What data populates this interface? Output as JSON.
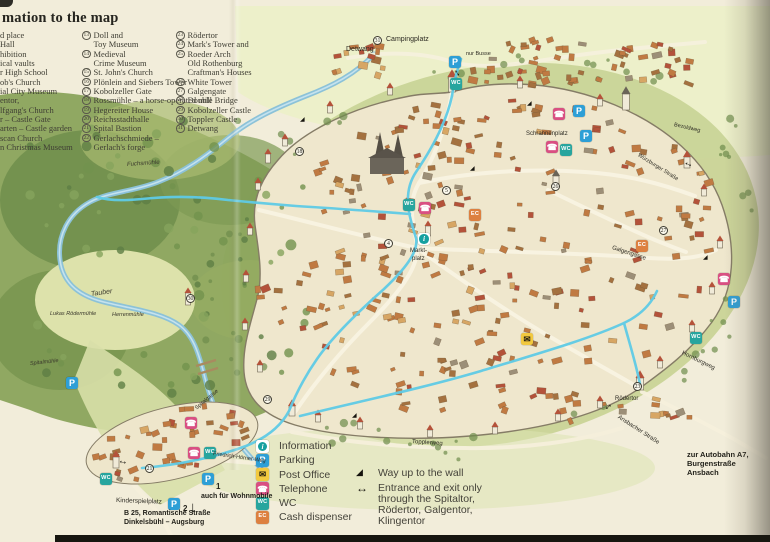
{
  "page": {
    "title_fragment": "mation to the map"
  },
  "legend": {
    "left_fragments": [
      "d place",
      "Hall",
      "hibition",
      "ical vaults",
      "r High School",
      "ob's Church",
      "ial City Museum",
      "entor,",
      "lfgang's Church",
      "r – Castle Gate",
      "arten – Castle garden",
      "scan Church",
      "n Christmas Museum"
    ],
    "middle_rows": [
      {
        "num": "13",
        "text": "Doll and"
      },
      {
        "num": "",
        "text": "Toy Museum"
      },
      {
        "num": "14",
        "text": "Medieval"
      },
      {
        "num": "",
        "text": "Crime Museum"
      },
      {
        "num": "15",
        "text": "St. John's Church"
      },
      {
        "num": "16",
        "text": "Plönlein and Siebers Tower"
      },
      {
        "num": "17",
        "text": "Kobolzeller Gate"
      },
      {
        "num": "18",
        "text": "Rossmühle – a horse-operated mill"
      },
      {
        "num": "19",
        "text": "Hegereiter House"
      },
      {
        "num": "20",
        "text": "Reichsstadthalle"
      },
      {
        "num": "21",
        "text": "Spital Bastion"
      },
      {
        "num": "22",
        "text": "Gerlachschmiede –"
      },
      {
        "num": "",
        "text": "Gerlach's forge"
      }
    ],
    "right_rows": [
      {
        "num": "23",
        "text": "Rödertor"
      },
      {
        "num": "24",
        "text": "Mark's Tower and"
      },
      {
        "num": "25",
        "text": "Roeder Arch"
      },
      {
        "num": "",
        "text": "Old Rothenburg"
      },
      {
        "num": "",
        "text": "Craftman's Houses"
      },
      {
        "num": "26",
        "text": "White Tower"
      },
      {
        "num": "27",
        "text": "Galgengate"
      },
      {
        "num": "28",
        "text": "Double Bridge"
      },
      {
        "num": "29",
        "text": "Kobolzeller Castle"
      },
      {
        "num": "30",
        "text": "Toppler Castle"
      },
      {
        "num": "31",
        "text": "Detwang"
      }
    ]
  },
  "icon_types": {
    "info": {
      "name": "information",
      "glyph": "i",
      "bg": "#ffffff",
      "fg": "#ffffff"
    },
    "p": {
      "name": "parking",
      "glyph": "P",
      "bg": "#2d9fd6",
      "fg": "#ffffff"
    },
    "post": {
      "name": "post-office",
      "glyph": "✉",
      "bg": "#f2c93f",
      "fg": "#2a2313"
    },
    "tel": {
      "name": "telephone",
      "glyph": "☎",
      "bg": "#d94f82",
      "fg": "#ffffff"
    },
    "wc": {
      "name": "wc",
      "glyph": "WC",
      "bg": "#27a59e",
      "fg": "#ffffff"
    },
    "ec": {
      "name": "cash-dispenser",
      "glyph": "EC",
      "bg": "#dd8040",
      "fg": "#ffffff"
    }
  },
  "key": {
    "items": [
      {
        "type": "info",
        "label": "Information"
      },
      {
        "type": "p",
        "label": "Parking"
      },
      {
        "type": "post",
        "label": "Post Office"
      },
      {
        "type": "tel",
        "label": "Telephone"
      },
      {
        "type": "wc",
        "label": "WC"
      },
      {
        "type": "ec",
        "label": "Cash dispenser"
      }
    ],
    "wall_note": {
      "glyph": "◢",
      "label": "Way up to the wall"
    },
    "entrance_note": {
      "glyph": "↔",
      "lines": [
        "Entrance and exit only",
        "through the Spitaltor,",
        "Rödertor, Galgentor,",
        "Klingentor"
      ]
    }
  },
  "map": {
    "icons": [
      {
        "type": "p",
        "x": 449,
        "y": 56
      },
      {
        "type": "p",
        "x": 573,
        "y": 105
      },
      {
        "type": "p",
        "x": 580,
        "y": 130
      },
      {
        "type": "p",
        "x": 728,
        "y": 296
      },
      {
        "type": "p",
        "x": 66,
        "y": 377
      },
      {
        "type": "p",
        "x": 202,
        "y": 473
      },
      {
        "type": "p",
        "x": 168,
        "y": 498
      },
      {
        "type": "wc",
        "x": 450,
        "y": 78
      },
      {
        "type": "wc",
        "x": 403,
        "y": 199
      },
      {
        "type": "wc",
        "x": 560,
        "y": 144
      },
      {
        "type": "wc",
        "x": 690,
        "y": 332
      },
      {
        "type": "wc",
        "x": 204,
        "y": 447
      },
      {
        "type": "wc",
        "x": 100,
        "y": 473
      },
      {
        "type": "tel",
        "x": 553,
        "y": 108
      },
      {
        "type": "tel",
        "x": 546,
        "y": 141
      },
      {
        "type": "tel",
        "x": 419,
        "y": 202
      },
      {
        "type": "tel",
        "x": 718,
        "y": 273
      },
      {
        "type": "tel",
        "x": 185,
        "y": 417
      },
      {
        "type": "tel",
        "x": 188,
        "y": 447
      },
      {
        "type": "post",
        "x": 521,
        "y": 333
      },
      {
        "type": "ec",
        "x": 469,
        "y": 209
      },
      {
        "type": "ec",
        "x": 636,
        "y": 240
      },
      {
        "type": "info",
        "x": 418,
        "y": 233
      }
    ],
    "numbers": [
      {
        "n": "31",
        "x": 373,
        "y": 36
      },
      {
        "n": "5",
        "x": 442,
        "y": 186
      },
      {
        "n": "4",
        "x": 384,
        "y": 239
      },
      {
        "n": "26",
        "x": 551,
        "y": 182
      },
      {
        "n": "27",
        "x": 659,
        "y": 226
      },
      {
        "n": "23",
        "x": 633,
        "y": 382
      },
      {
        "n": "29",
        "x": 263,
        "y": 395
      },
      {
        "n": "30",
        "x": 186,
        "y": 294
      },
      {
        "n": "21",
        "x": 145,
        "y": 464
      },
      {
        "n": "18",
        "x": 295,
        "y": 147
      }
    ],
    "labels": [
      {
        "t": "Detwang",
        "x": 346,
        "y": 46,
        "s": 7
      },
      {
        "t": "Campingplatz",
        "x": 386,
        "y": 36,
        "s": 7
      },
      {
        "t": "nur Busse",
        "x": 466,
        "y": 51,
        "s": 5.5
      },
      {
        "t": "Fuchsmühle",
        "x": 127,
        "y": 162,
        "s": 6,
        "r": -4,
        "cls": "i"
      },
      {
        "t": "Tauber",
        "x": 91,
        "y": 291,
        "s": 7,
        "r": -8,
        "cls": "i"
      },
      {
        "t": "Lukas Rödermühle",
        "x": 50,
        "y": 311,
        "s": 5.5,
        "cls": "i"
      },
      {
        "t": "Herrenmühle",
        "x": 112,
        "y": 312,
        "s": 5.5,
        "cls": "i"
      },
      {
        "t": "Spitalmühle",
        "x": 30,
        "y": 361,
        "s": 5.5,
        "r": -6,
        "cls": "i"
      },
      {
        "t": "Markt-",
        "x": 410,
        "y": 248,
        "s": 6
      },
      {
        "t": "platz",
        "x": 412,
        "y": 256,
        "s": 6
      },
      {
        "t": "Schrannenplatz",
        "x": 526,
        "y": 131,
        "s": 6
      },
      {
        "t": "Galgengasse",
        "x": 612,
        "y": 245,
        "s": 6,
        "r": 18
      },
      {
        "t": "Bezoldweg",
        "x": 674,
        "y": 122,
        "s": 5.5,
        "r": 13
      },
      {
        "t": "Würzburger Straße",
        "x": 638,
        "y": 152,
        "s": 5.5,
        "r": 32
      },
      {
        "t": "Hornburgweg",
        "x": 682,
        "y": 350,
        "s": 6,
        "r": 26
      },
      {
        "t": "Rödertor",
        "x": 615,
        "y": 396,
        "s": 6
      },
      {
        "t": "Ansbacher Straße",
        "x": 618,
        "y": 414,
        "s": 6,
        "r": 33
      },
      {
        "t": "zur Autobahn A7,",
        "x": 687,
        "y": 450,
        "s": 7.5,
        "cls": "b"
      },
      {
        "t": "Burgenstraße",
        "x": 687,
        "y": 459,
        "s": 7.5,
        "cls": "b"
      },
      {
        "t": "Ansbach",
        "x": 687,
        "y": 468,
        "s": 7.5,
        "cls": "b"
      },
      {
        "t": "Topplerweg",
        "x": 412,
        "y": 439,
        "s": 6,
        "r": 4
      },
      {
        "t": "Friedrich-Hörner-Weg",
        "x": 213,
        "y": 451,
        "s": 5.5,
        "r": 8
      },
      {
        "t": "Spitalgasse",
        "x": 196,
        "y": 406,
        "s": 5.5,
        "r": -40
      },
      {
        "t": "Kinderspielplatz",
        "x": 116,
        "y": 497,
        "s": 6.5,
        "r": 2
      },
      {
        "t": "B 25, Romantische Straße",
        "x": 124,
        "y": 510,
        "s": 7,
        "cls": "b"
      },
      {
        "t": "Dinkelsbühl – Augsburg",
        "x": 124,
        "y": 519,
        "s": 7,
        "cls": "b"
      },
      {
        "t": "auch für Wohnmobile",
        "x": 201,
        "y": 493,
        "s": 7,
        "cls": "b"
      },
      {
        "t": "1",
        "x": 216,
        "y": 482,
        "s": 8,
        "cls": "b"
      },
      {
        "t": "2",
        "x": 183,
        "y": 504,
        "s": 8,
        "cls": "b"
      },
      {
        "t": "↓",
        "x": 189,
        "y": 499,
        "s": 15,
        "cls": "b"
      },
      {
        "t": "↔",
        "x": 455,
        "y": 63,
        "s": 10,
        "r": 55,
        "cls": "arrow b"
      },
      {
        "t": "↔",
        "x": 604,
        "y": 404,
        "s": 10,
        "r": -40,
        "cls": "arrow b"
      },
      {
        "t": "↔",
        "x": 684,
        "y": 156,
        "s": 10,
        "r": 25,
        "cls": "arrow b"
      },
      {
        "t": "↔",
        "x": 118,
        "y": 455,
        "s": 10,
        "r": 10,
        "cls": "arrow b"
      },
      {
        "t": "◢",
        "x": 300,
        "y": 116,
        "s": 6,
        "cls": "wedge"
      },
      {
        "t": "◢",
        "x": 527,
        "y": 100,
        "s": 6,
        "cls": "wedge"
      },
      {
        "t": "◢",
        "x": 703,
        "y": 254,
        "s": 6,
        "cls": "wedge"
      },
      {
        "t": "◢",
        "x": 352,
        "y": 412,
        "s": 6,
        "cls": "wedge"
      },
      {
        "t": "◢",
        "x": 470,
        "y": 165,
        "s": 6,
        "cls": "wedge"
      }
    ]
  },
  "colors": {
    "paper": "#f2edda",
    "meadow": "#c9d497",
    "forest": "#8aa45c",
    "river": "#8cc2d8",
    "route": "#5fcbe6",
    "town_fill": "#efe7cd",
    "wall": "#857c66",
    "roof_red": "#b4523a"
  }
}
